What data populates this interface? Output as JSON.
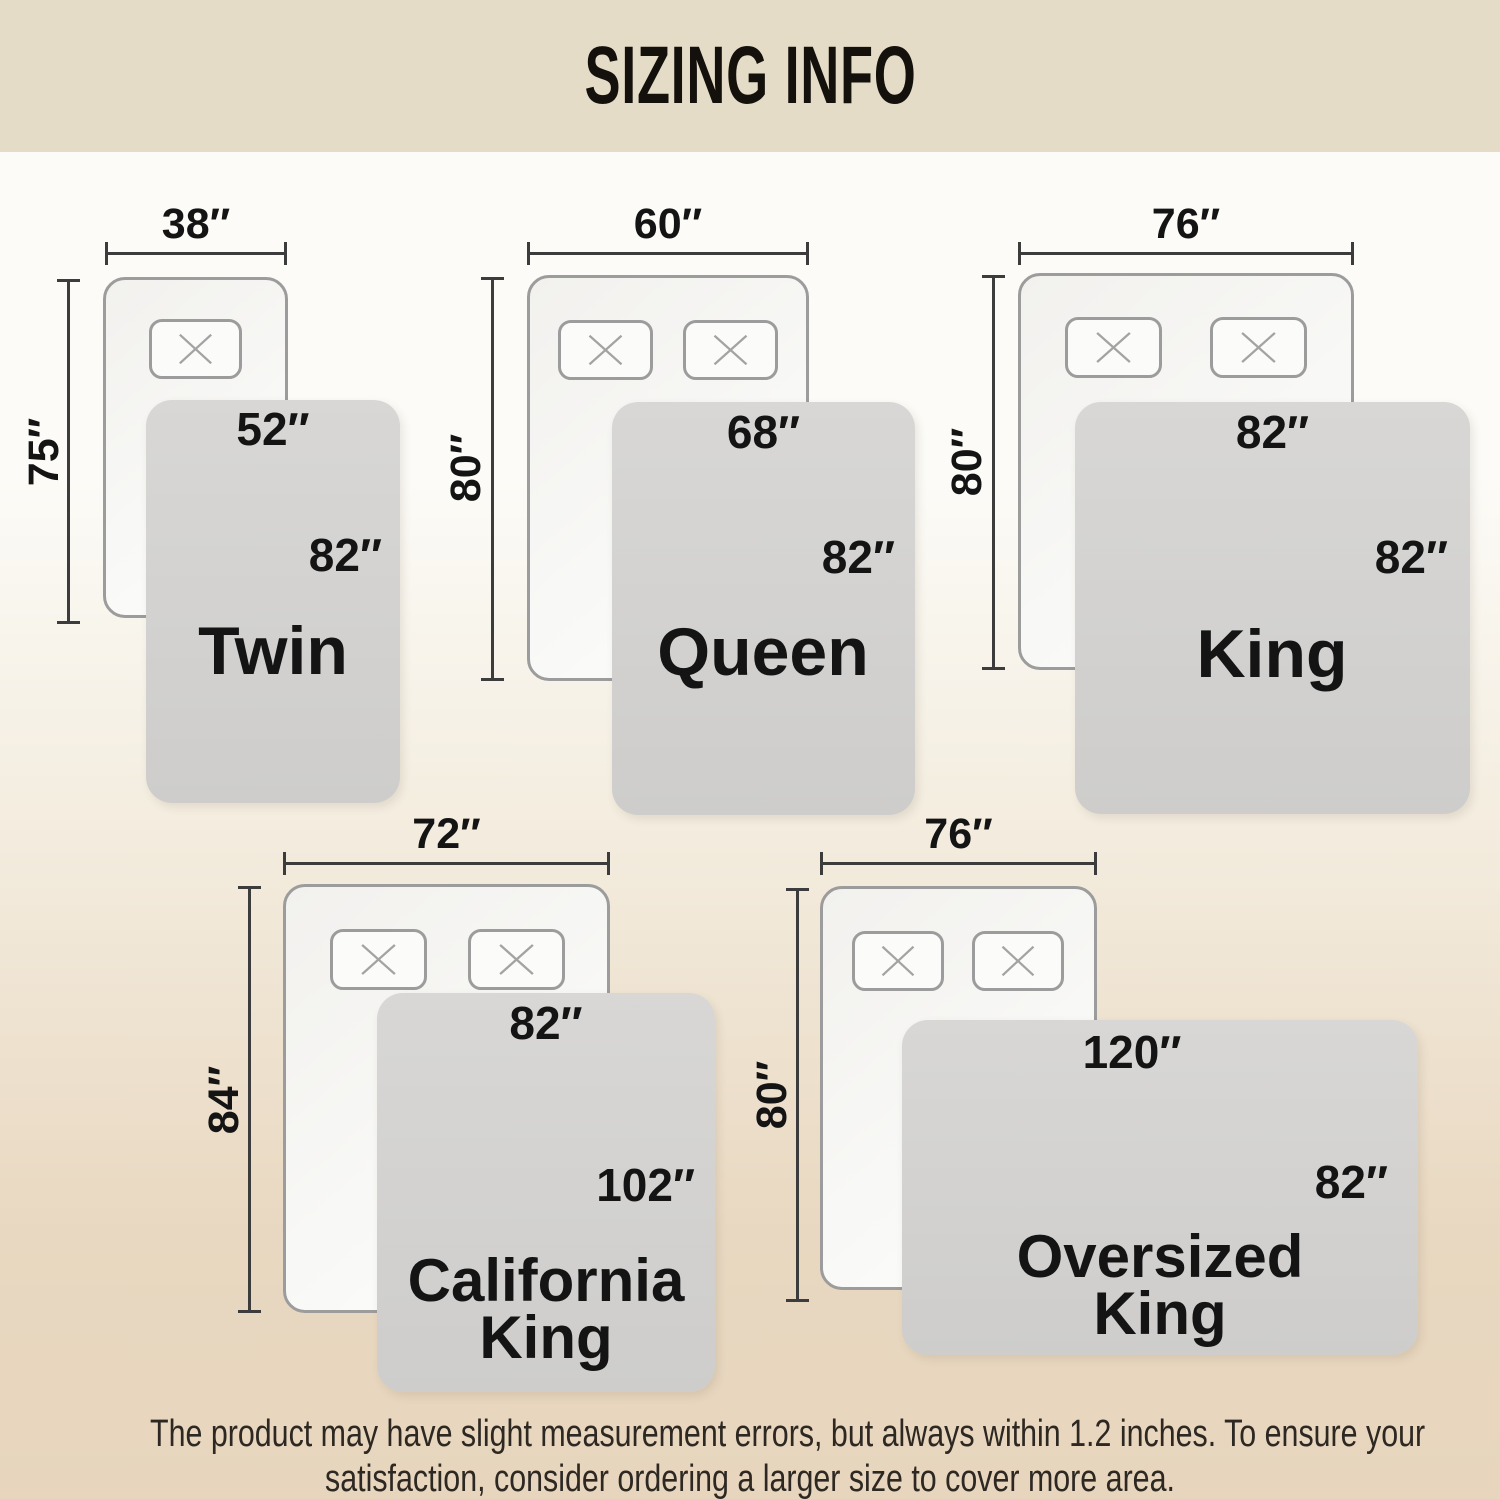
{
  "page": {
    "title": "SIZING INFO"
  },
  "beds": [
    {
      "name_lines": [
        "Twin"
      ],
      "mattress_width": "38″",
      "mattress_length": "75″",
      "blanket_width": "52″",
      "blanket_length": "82″",
      "pillow_count": 1
    },
    {
      "name_lines": [
        "Queen"
      ],
      "mattress_width": "60″",
      "mattress_length": "80″",
      "blanket_width": "68″",
      "blanket_length": "82″",
      "pillow_count": 2
    },
    {
      "name_lines": [
        "King"
      ],
      "mattress_width": "76″",
      "mattress_length": "80″",
      "blanket_width": "82″",
      "blanket_length": "82″",
      "pillow_count": 2
    },
    {
      "name_lines": [
        "California",
        "King"
      ],
      "mattress_width": "72″",
      "mattress_length": "84″",
      "blanket_width": "82″",
      "blanket_length": "102″",
      "pillow_count": 2
    },
    {
      "name_lines": [
        "Oversized",
        "King"
      ],
      "mattress_width": "76″",
      "mattress_length": "80″",
      "blanket_width": "120″",
      "blanket_length": "82″",
      "pillow_count": 2
    }
  ],
  "footer": {
    "line1": "The product may have slight measurement errors, but always within 1.2 inches. To ensure your",
    "line2": "satisfaction, consider ordering a larger size to cover more area."
  },
  "colors": {
    "header_bg": "#e5dcc8",
    "page_top": "#fcfbf7",
    "page_mid": "#f3ecde",
    "page_bottom": "#e9d8c1",
    "page_bottom2": "#e7d5bd",
    "blanket_fill": "#d4d3d1",
    "mattress_fill": "#f8f7f5",
    "mattress_border": "#9c9c9c",
    "dim_line": "#3c3c3c",
    "label_text": "#141414",
    "footer_text": "#2d2822"
  }
}
